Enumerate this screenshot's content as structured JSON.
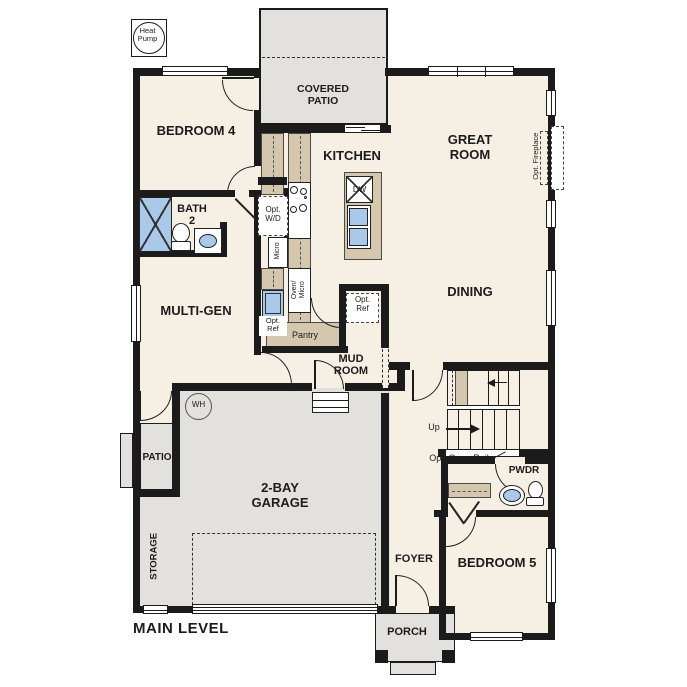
{
  "title": "MAIN LEVEL",
  "colors": {
    "floor": "#f6efe4",
    "concrete": "#e3e1de",
    "counter_tan": "#d5c7ad",
    "wall": "#1b1b1b",
    "fixture_blue": "#aac9e8"
  },
  "rooms": {
    "bedroom4": "BEDROOM 4",
    "bath2": "BATH\n2",
    "multigen": "MULTI-GEN",
    "kitchen": "KITCHEN",
    "covered_patio": "COVERED\nPATIO",
    "great_room": "GREAT\nROOM",
    "dining": "DINING",
    "mud_room": "MUD\nROOM",
    "pantry": "Pantry",
    "garage": "2-BAY\nGARAGE",
    "storage": "STORAGE",
    "patio": "PATIO",
    "foyer": "FOYER",
    "porch": "PORCH",
    "bedroom5": "BEDROOM 5",
    "pwdr": "PWDR"
  },
  "labels": {
    "heat_pump": "Heat\nPump",
    "opt_wd": "Opt.\nW/D",
    "micro": "Micro",
    "oven_micro": "Oven/\nMicro",
    "opt_ref_kitchen": "Opt.\nRef",
    "opt_ref_mud": "Opt.\nRef",
    "opt_fireplace": "Opt. Fireplace",
    "dw": "DW",
    "wh": "WH",
    "up": "Up",
    "opt_open_rail": "Opt. Open Rail"
  }
}
